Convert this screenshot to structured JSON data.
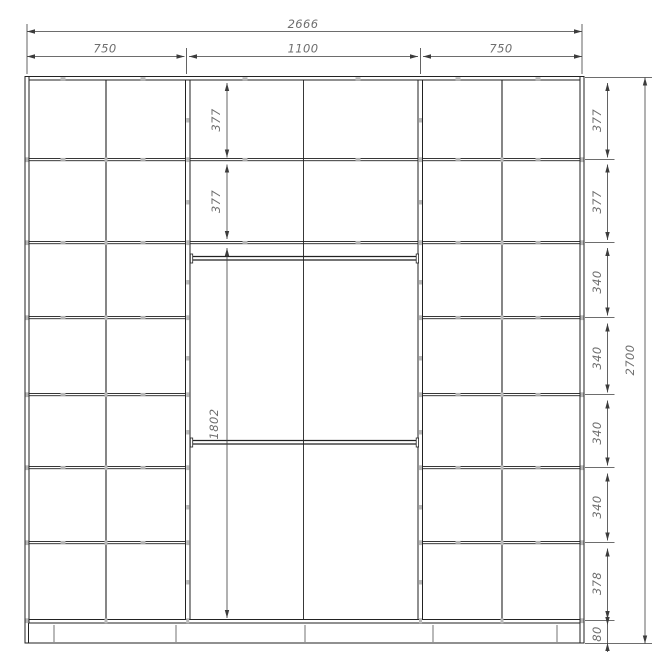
{
  "drawing": {
    "dimensions": {
      "total_width": "2666",
      "total_height": "2700",
      "top_sections": [
        {
          "label": "750"
        },
        {
          "label": "1100"
        },
        {
          "label": "750"
        }
      ],
      "middle_column": [
        {
          "label": "377"
        },
        {
          "label": "377"
        },
        {
          "label": "1802"
        }
      ],
      "right_column": [
        {
          "label": "377"
        },
        {
          "label": "377"
        },
        {
          "label": "340"
        },
        {
          "label": "340"
        },
        {
          "label": "340"
        },
        {
          "label": "340"
        },
        {
          "label": "378"
        },
        {
          "label": "80"
        }
      ]
    },
    "colors": {
      "structure_line": "#222222",
      "dimension_line": "#3c3c3c",
      "label_text": "#6e6e6e",
      "connector_mark": "#b9b9b9",
      "background": "#ffffff"
    }
  }
}
